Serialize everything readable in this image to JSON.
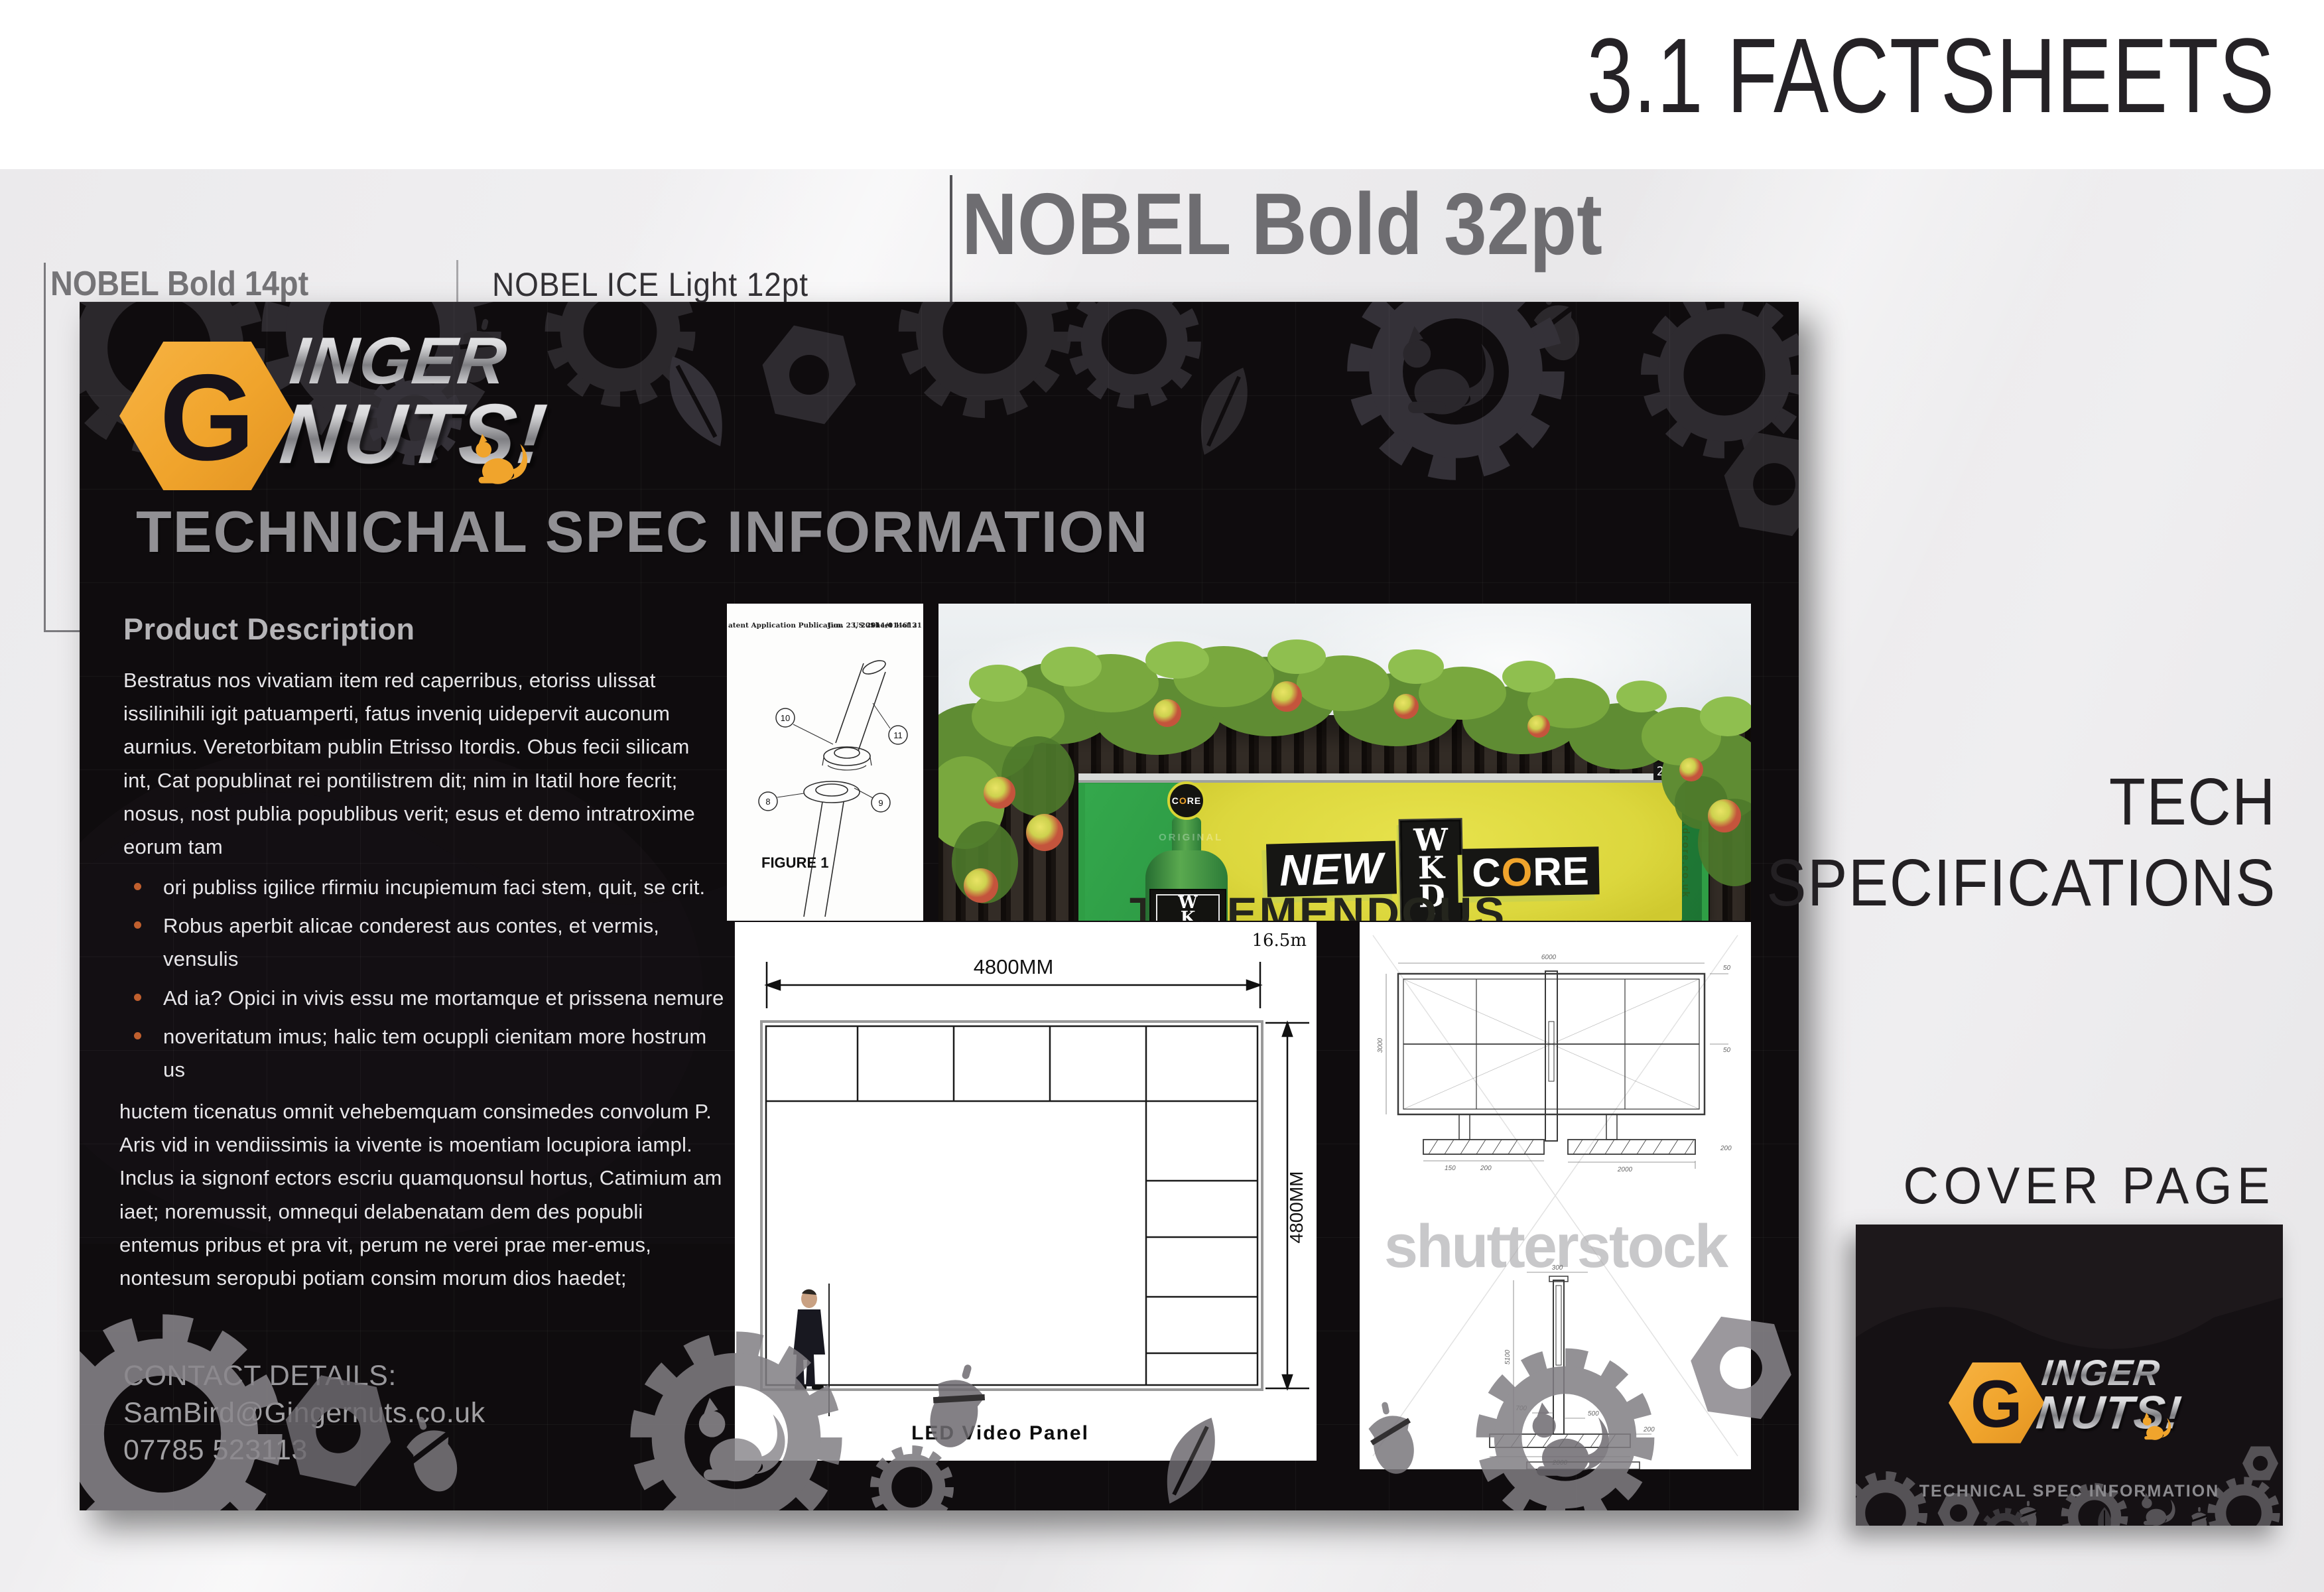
{
  "header": {
    "title": "3.1 FACTSHEETS"
  },
  "annotations": {
    "bold14": "NOBEL Bold 14pt",
    "light12": "NOBEL ICE Light 12pt",
    "bold32": "NOBEL Bold 32pt"
  },
  "side": {
    "tech_line1": "TECH",
    "tech_line2": "SPECIFICATIONS",
    "cover_label": "COVER PAGE"
  },
  "factsheet": {
    "logo": {
      "g": "G",
      "top": "INGER",
      "bottom": "NUTS!"
    },
    "heading": "TECHNICHAL SPEC INFORMATION",
    "section_title": "Product Description",
    "paragraph1": "Bestratus nos vivatiam item red caperribus, etoriss ulissat issilinihili igit patuamperti, fatus inveniq uidepervit auconum aurnius. Veretorbitam publin Etrisso Itordis. Obus fecii silicam int, Cat popublinat rei pontilistrem dit; nim in Itatil hore fecrit; nosus, nost publia popublibus verit; esus et demo intratroxime eorum tam",
    "bullets": [
      "ori publiss igilice rfirmiu incupiemum faci stem, quit, se crit.",
      "Robus aperbit alicae conderest aus contes, et vermis, vensulis",
      "Ad ia? Opici in vivis essu me mortamque et prissena nemure",
      "noveritatum imus; halic tem ocuppli cienitam more hostrum us"
    ],
    "paragraph2": "huctem ticenatus omnit vehebemquam consimedes convolum P. Aris vid in vendiissimis ia vivente is moentiam locupiora iampl. Inclus ia signonf ectors escriu quamquonsul hortus, Catimium am iaet; noremussit, omnequi delabenatam dem des popubli entemus pribus et pra vit, perum ne verei prae mer-emus, nontesum seropubi potiam consim morum dios haedet;",
    "contact": {
      "label": "CONTACT DETAILS:",
      "email": "SamBird@Gingernuts.co.uk",
      "phone": "07785 523113"
    }
  },
  "patent": {
    "header_left": "atent Application Publication",
    "header_date": "Jun. 23, 2011",
    "header_sheet": "Sheet 1 of 3",
    "header_number": "US 2011/0146121",
    "figure_label": "FIGURE 1",
    "callout_8": "8",
    "callout_9": "9",
    "callout_10": "10",
    "callout_11": "11"
  },
  "billboard": {
    "plate": "246704",
    "new_label": "NEW",
    "wkd_w": "W",
    "wkd_k": "K",
    "wkd_d": "D",
    "reg": "®",
    "core_c": "C",
    "core_o": "O",
    "core_re": "RE",
    "headline": "TREEMENDOUS",
    "url": "wkdcore.co.uk",
    "badge_c": "C",
    "badge_o": "O",
    "badge_re": "RE",
    "bottle_emboss": "ORIGINAL"
  },
  "led": {
    "width_label": "4800MM",
    "height_label": "4800MM",
    "offset_label": "16.5m",
    "caption": "LED Video Panel"
  },
  "drawing": {
    "watermark": "shutterstock",
    "front_w": "6000",
    "front_h": "3000",
    "front_t1": "50",
    "front_t2": "50",
    "front_foot": "200",
    "front_d1": "150",
    "front_d2": "200",
    "front_d3": "2000",
    "side_top": "300",
    "side_h": "5100",
    "side_a": "700",
    "side_b": "500",
    "side_c": "200",
    "side_base": "2000"
  },
  "cover": {
    "subtitle": "TECHNICAL SPEC INFORMATION"
  },
  "colors": {
    "accent_orange": "#F0A42C",
    "bullet_orange": "#C05F2E",
    "panel_bg": "#0F0C0E",
    "billboard_yellow": "#DCD73D",
    "billboard_green": "#2F9E45",
    "page_gray": "#EAE9EB"
  }
}
